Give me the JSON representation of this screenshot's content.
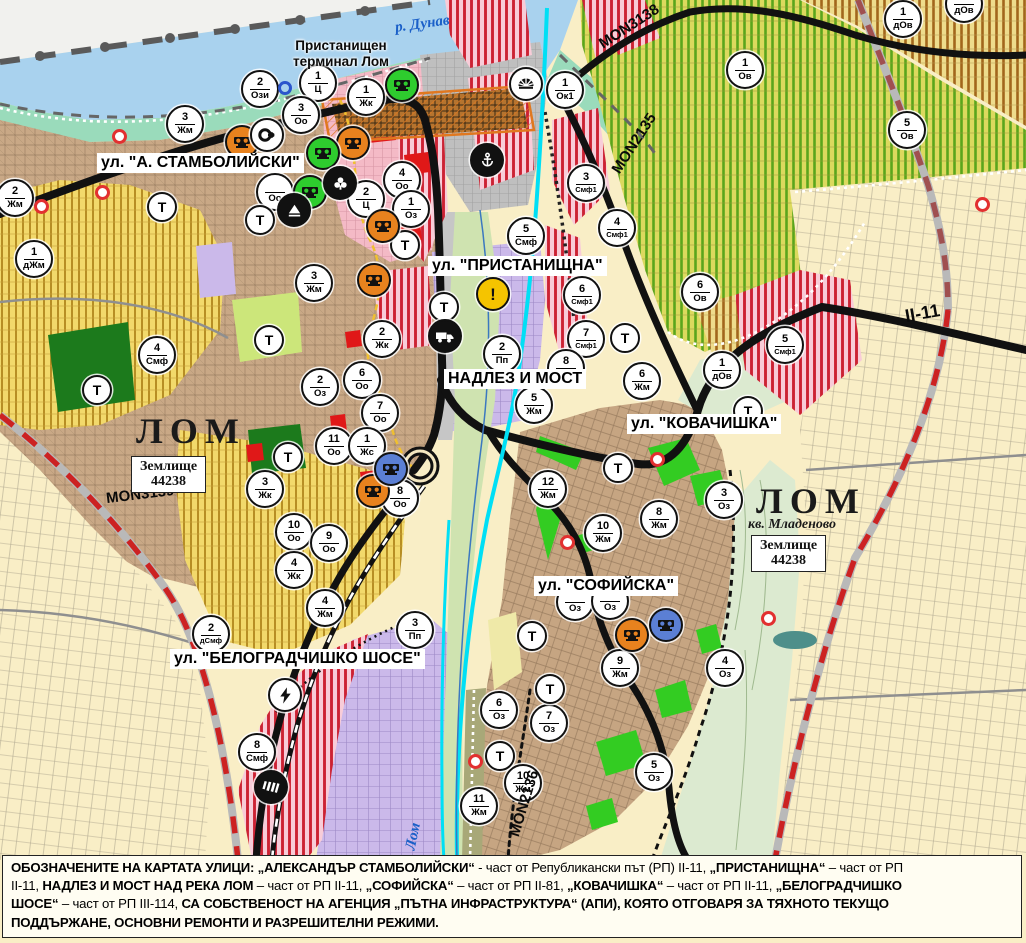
{
  "map": {
    "street_labels": [
      {
        "id": "stamboliyski",
        "text": "ул. \"А. СТАМБОЛИЙСКИ\"",
        "x": 97,
        "y": 153
      },
      {
        "id": "pristanishtna",
        "text": "ул. \"ПРИСТАНИЩНА\"",
        "x": 428,
        "y": 256
      },
      {
        "id": "nadlez-i-most",
        "text": "НАДЛЕЗ И МОСТ",
        "x": 444,
        "y": 369
      },
      {
        "id": "kovachishka",
        "text": "ул. \"КОВАЧИШКА\"",
        "x": 627,
        "y": 414
      },
      {
        "id": "sofiyska",
        "text": "ул. \"СОФИЙСКА\"",
        "x": 534,
        "y": 576
      },
      {
        "id": "belogradchishko",
        "text": "ул. \"БЕЛОГРАДЧИШКО ШОСЕ\"",
        "x": 170,
        "y": 649
      }
    ],
    "terminal_label": {
      "text": "Пристанищен\nтерминал Лом",
      "x": 341,
      "y": 38
    },
    "city_labels": [
      {
        "text": "ЛОМ",
        "x": 136,
        "y": 410
      },
      {
        "text": "ЛОМ",
        "x": 756,
        "y": 480
      }
    ],
    "quarter_label": {
      "text": "кв. Младеново",
      "x": 748,
      "y": 517
    },
    "land_boxes": [
      {
        "text": "Землище\n44238",
        "x": 131,
        "y": 456
      },
      {
        "text": "Землище\n44238",
        "x": 751,
        "y": 535
      }
    ],
    "road_labels": [
      {
        "text": "MON3138",
        "x": 595,
        "y": 18,
        "rot": -33
      },
      {
        "text": "MON2135",
        "x": 600,
        "y": 135,
        "rot": -57
      },
      {
        "text": "MON3139",
        "x": 106,
        "y": 486,
        "rot": -7
      },
      {
        "text": "MON2136",
        "x": 490,
        "y": 795,
        "rot": -73
      },
      {
        "text": "II-11",
        "x": 905,
        "y": 303,
        "rot": -10,
        "big": true
      }
    ],
    "water_labels": [
      {
        "text": "р. Дунав",
        "x": 395,
        "y": 16,
        "rot": -8
      },
      {
        "text": "Лом",
        "x": 400,
        "y": 828,
        "rot": -78
      }
    ],
    "zone_markers": [
      [
        13,
        196,
        "2",
        "Жм"
      ],
      [
        32,
        257,
        "1",
        "дЖм"
      ],
      [
        183,
        122,
        "3",
        "Жм"
      ],
      [
        258,
        87,
        "2",
        "Ози"
      ],
      [
        316,
        81,
        "1",
        "Ц"
      ],
      [
        299,
        113,
        "3",
        "Оо"
      ],
      [
        364,
        95,
        "1",
        "Жк"
      ],
      [
        273,
        190,
        "",
        "Оо"
      ],
      [
        400,
        178,
        "4",
        "Оо"
      ],
      [
        364,
        197,
        "2",
        "Ц"
      ],
      [
        409,
        207,
        "1",
        "Оз"
      ],
      [
        312,
        281,
        "3",
        "Жм"
      ],
      [
        380,
        337,
        "2",
        "Жк"
      ],
      [
        155,
        353,
        "4",
        "Смф"
      ],
      [
        318,
        385,
        "2",
        "Оз"
      ],
      [
        360,
        378,
        "6",
        "Оо"
      ],
      [
        378,
        411,
        "7",
        "Оо"
      ],
      [
        332,
        444,
        "11",
        "Оо"
      ],
      [
        365,
        444,
        "1",
        "Жс"
      ],
      [
        398,
        496,
        "8",
        "Оо"
      ],
      [
        263,
        487,
        "3",
        "Жк"
      ],
      [
        292,
        530,
        "10",
        "Оо"
      ],
      [
        327,
        541,
        "9",
        "Оо"
      ],
      [
        292,
        568,
        "4",
        "Жк"
      ],
      [
        323,
        606,
        "4",
        "Жм"
      ],
      [
        209,
        632,
        "2",
        "дСмф"
      ],
      [
        413,
        628,
        "3",
        "Пп"
      ],
      [
        255,
        750,
        "8",
        "Смф"
      ],
      [
        563,
        88,
        "1",
        "Ок1"
      ],
      [
        584,
        181,
        "3",
        "Смф1"
      ],
      [
        615,
        226,
        "4",
        "Смф1"
      ],
      [
        524,
        234,
        "5",
        "Смф"
      ],
      [
        580,
        293,
        "6",
        "Смф1"
      ],
      [
        584,
        337,
        "7",
        "Смф1"
      ],
      [
        500,
        352,
        "2",
        "Пп"
      ],
      [
        564,
        366,
        "8",
        "Жм"
      ],
      [
        532,
        403,
        "5",
        "Жм"
      ],
      [
        640,
        379,
        "6",
        "Жм"
      ],
      [
        743,
        68,
        "1",
        "Ов"
      ],
      [
        901,
        17,
        "1",
        "дОв"
      ],
      [
        962,
        2,
        "",
        "дОв"
      ],
      [
        905,
        128,
        "5",
        "Ов"
      ],
      [
        698,
        290,
        "6",
        "Ов"
      ],
      [
        783,
        343,
        "5",
        "Смф1"
      ],
      [
        720,
        368,
        "1",
        "дОв"
      ],
      [
        546,
        487,
        "12",
        "Жм"
      ],
      [
        601,
        531,
        "10",
        "Жм"
      ],
      [
        657,
        517,
        "8",
        "Жм"
      ],
      [
        722,
        498,
        "3",
        "Оз"
      ],
      [
        573,
        600,
        "",
        "Оз"
      ],
      [
        608,
        599,
        "",
        "Оз"
      ],
      [
        618,
        666,
        "9",
        "Жм"
      ],
      [
        723,
        666,
        "4",
        "Оз"
      ],
      [
        497,
        708,
        "6",
        "Оз"
      ],
      [
        547,
        721,
        "7",
        "Оз"
      ],
      [
        521,
        781,
        "10",
        "Жм"
      ],
      [
        477,
        804,
        "11",
        "Жм"
      ],
      [
        652,
        770,
        "5",
        "Оз"
      ]
    ],
    "t_markers": [
      [
        160,
        205
      ],
      [
        258,
        218
      ],
      [
        403,
        243
      ],
      [
        267,
        338
      ],
      [
        95,
        388
      ],
      [
        286,
        455
      ],
      [
        442,
        305
      ],
      [
        623,
        336
      ],
      [
        746,
        409
      ],
      [
        616,
        466
      ],
      [
        530,
        634
      ],
      [
        548,
        687
      ],
      [
        498,
        754
      ]
    ],
    "icon_markers": [
      {
        "type": "heritage",
        "color": "orange",
        "x": 240,
        "y": 140
      },
      {
        "type": "heritage",
        "color": "orange",
        "x": 351,
        "y": 141
      },
      {
        "type": "heritage",
        "color": "orange",
        "x": 381,
        "y": 224
      },
      {
        "type": "heritage",
        "color": "orange",
        "x": 372,
        "y": 278
      },
      {
        "type": "heritage",
        "color": "orange",
        "x": 371,
        "y": 489
      },
      {
        "type": "heritage",
        "color": "orange",
        "x": 630,
        "y": 633
      },
      {
        "type": "heritage",
        "color": "green",
        "x": 321,
        "y": 151
      },
      {
        "type": "heritage",
        "color": "green",
        "x": 400,
        "y": 83
      },
      {
        "type": "heritage",
        "color": "green",
        "x": 308,
        "y": 190
      },
      {
        "type": "heritage",
        "color": "blue",
        "x": 389,
        "y": 467
      },
      {
        "type": "heritage",
        "color": "blue",
        "x": 664,
        "y": 623
      },
      {
        "type": "circle-arrow",
        "color": "white",
        "x": 265,
        "y": 133
      },
      {
        "type": "trefoil",
        "color": "black",
        "x": 338,
        "y": 181
      },
      {
        "type": "mountain",
        "color": "black",
        "x": 292,
        "y": 208
      },
      {
        "type": "anchor",
        "color": "black",
        "x": 485,
        "y": 158
      },
      {
        "type": "fan",
        "color": "white",
        "x": 524,
        "y": 82
      },
      {
        "type": "warning",
        "color": "yellow",
        "x": 491,
        "y": 292
      },
      {
        "type": "truck",
        "color": "black",
        "x": 443,
        "y": 334
      },
      {
        "type": "lightning",
        "color": "white",
        "x": 283,
        "y": 693
      },
      {
        "type": "bridge",
        "color": "black",
        "x": 269,
        "y": 785
      }
    ],
    "red_dots": [
      [
        120,
        137
      ],
      [
        103,
        193
      ],
      [
        42,
        207
      ],
      [
        568,
        543
      ],
      [
        658,
        460
      ],
      [
        476,
        762
      ],
      [
        769,
        619
      ],
      [
        983,
        205
      ]
    ],
    "blue_rings": [
      [
        285,
        88
      ]
    ]
  },
  "caption": {
    "lines": [
      [
        {
          "t": "ОБОЗНАЧЕНИТЕ НА КАРТАТА УЛИЦИ: „АЛЕКСАНДЪР СТАМБОЛИЙСКИ“",
          "b": 1
        },
        {
          "t": " - част от Републикански път (РП) II-11, ",
          "b": 0
        },
        {
          "t": "„ПРИСТАНИЩНА“",
          "b": 1
        },
        {
          "t": " – част от РП",
          "b": 0
        }
      ],
      [
        {
          "t": "II-11, ",
          "b": 0
        },
        {
          "t": "НАДЛЕЗ И МОСТ НАД РЕКА ЛОМ",
          "b": 1
        },
        {
          "t": " – част от РП II-11, ",
          "b": 0
        },
        {
          "t": "„СОФИЙСКА“",
          "b": 1
        },
        {
          "t": " – част от РП II-81, ",
          "b": 0
        },
        {
          "t": "„КОВАЧИШКА“",
          "b": 1
        },
        {
          "t": " – част от РП II-11, ",
          "b": 0
        },
        {
          "t": "„БЕЛОГРАДЧИШКО",
          "b": 1
        }
      ],
      [
        {
          "t": "ШОСЕ“",
          "b": 1
        },
        {
          "t": " – част от РП III-114, ",
          "b": 0
        },
        {
          "t": "СА СОБСТВЕНОСТ НА АГЕНЦИЯ „ПЪТНА ИНФРАСТРУКТУРА“ (АПИ), КОЯТО ОТГОВАРЯ ЗА ТЯХНОТО ТЕКУЩО",
          "b": 1
        }
      ],
      [
        {
          "t": "ПОДДЪРЖАНЕ, ОСНОВНИ РЕМОНТИ И РАЗРЕШИТЕЛНИ РЕЖИМИ.",
          "b": 1
        }
      ]
    ]
  },
  "colors": {
    "water": "#a9d2ee",
    "shore": "#9adbbb",
    "urban": "#c9a886",
    "vineyard_stripe": "#5aa51c",
    "red_stripe": "#cc2233",
    "purple": "#cbb9ea",
    "cream": "#f9eec6",
    "road": "#111111",
    "boundary_red": "#cc2222",
    "canal_cyan": "#00dff5",
    "heritage_orange": "#e8821e",
    "heritage_green": "#2ecc2e",
    "heritage_blue": "#5b7fd4",
    "warning_yellow": "#f5c400",
    "white": "#ffffff",
    "black": "#111111"
  }
}
